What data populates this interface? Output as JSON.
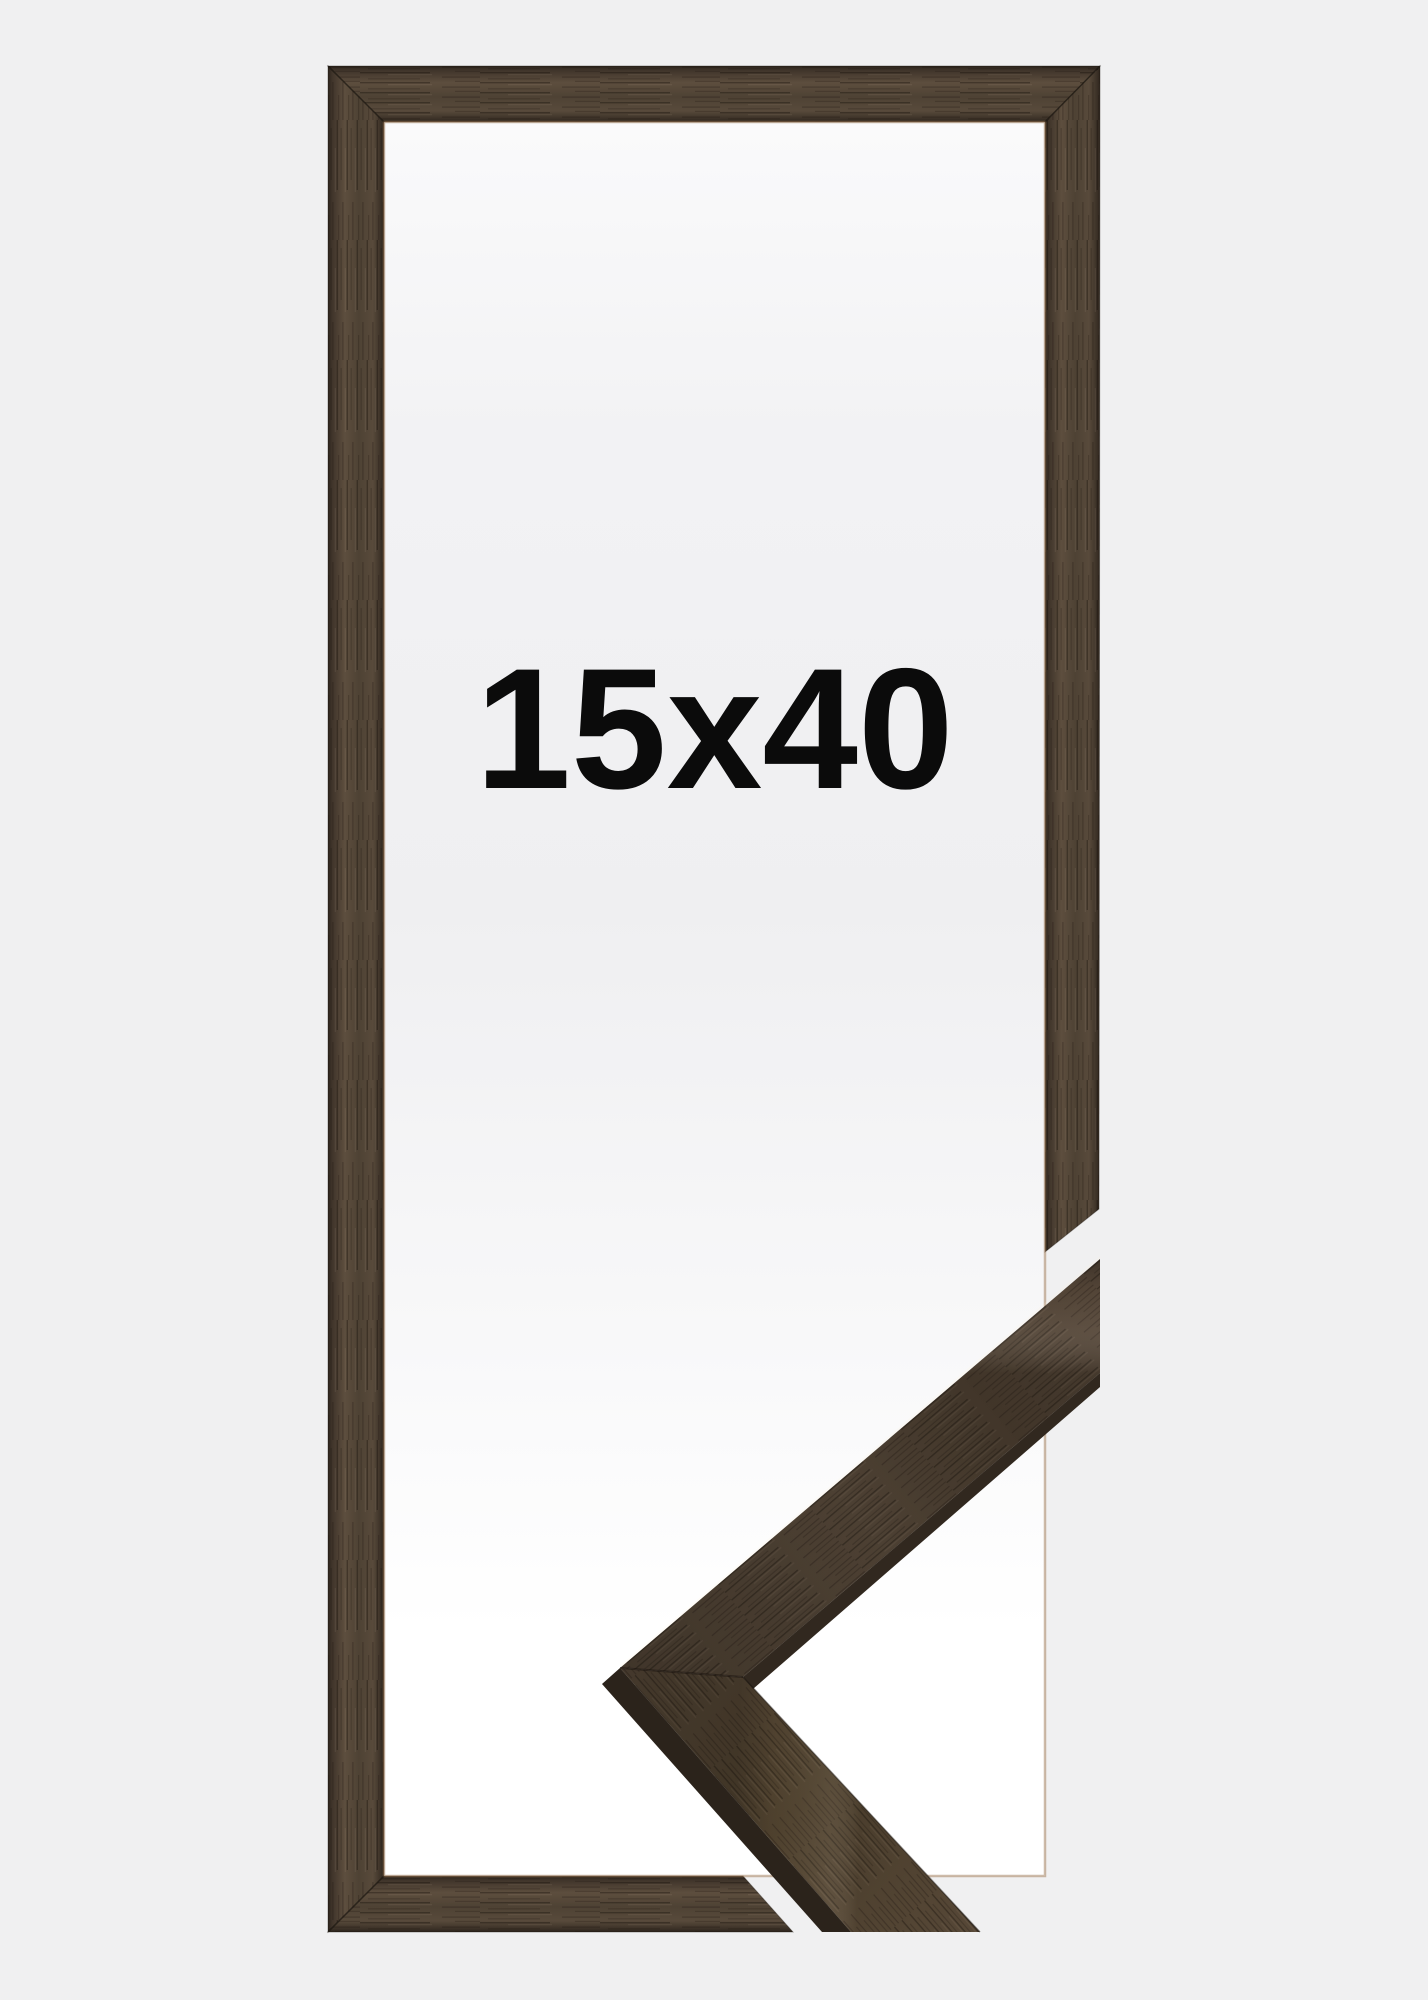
{
  "product_photo": {
    "size_label": "15x40",
    "colors": {
      "page_background": "#f0f0f1",
      "backing_white": "#ffffff",
      "backing_gray": "#efeff1",
      "backing_top": "#fafafb",
      "wood_darkest": "#2c241c",
      "wood_dark": "#3f342a",
      "wood_mid": "#4e4234",
      "wood_light": "#5d4e3e",
      "sample_wood_light": "#63523f",
      "edge_face_dark": "#31281f",
      "inner_lip": "#9e7854",
      "label": "#0b0b0b"
    }
  }
}
